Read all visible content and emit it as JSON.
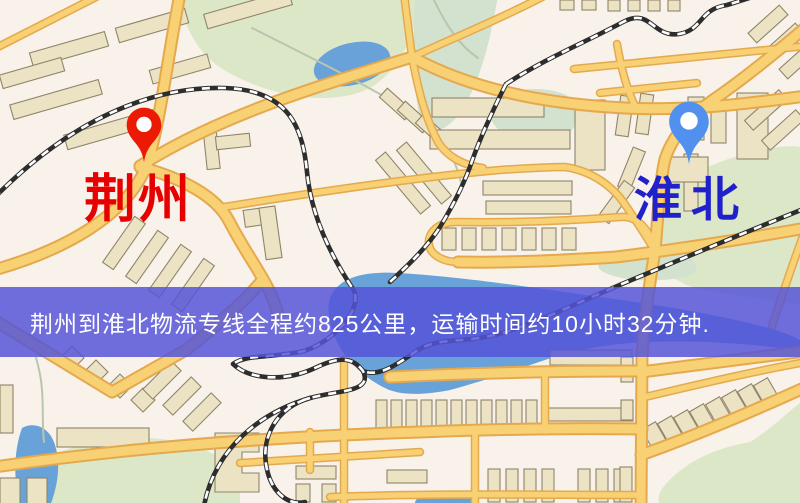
{
  "banner": {
    "text": "荆州到淮北物流专线全程约825公里，运输时间约10小时32分钟."
  },
  "origin": {
    "label": "荆州"
  },
  "destination": {
    "label": "淮北"
  },
  "palette": {
    "map_bg": "#f8f2ea",
    "road_fill": "#f8d174",
    "road_casing": "#e5a94d",
    "building_fill": "#ece2c4",
    "building_edge": "#90856a",
    "green_area": "#dce7c8",
    "green_area_soft": "#d2e2cf",
    "water": "#68a2d8",
    "stream": "#b9c6ae",
    "railway_dark": "#2d2d2d",
    "railway_light": "#ffffff",
    "origin_label_color": "#e60000",
    "origin_pin_color": "#ec1a04",
    "destination_label_color": "#2121cb",
    "destination_pin_color": "#5290f0",
    "banner_bg": "#5353d8",
    "banner_bg_rgba": "rgba(83,83,216,0.84)",
    "banner_text": "#ffffff"
  }
}
